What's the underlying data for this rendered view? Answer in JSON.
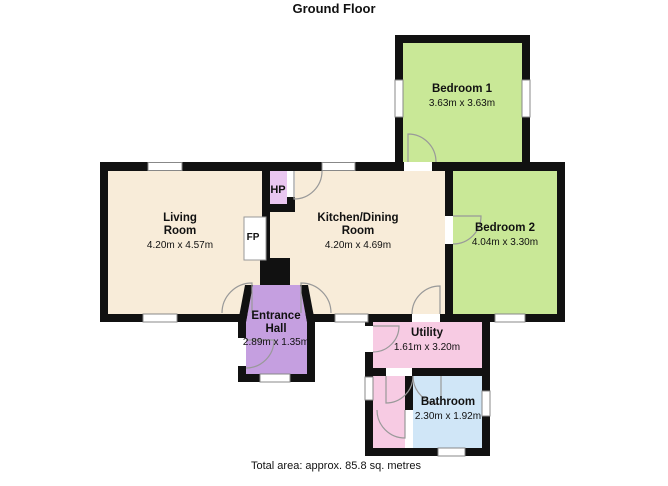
{
  "title": "Ground Floor",
  "footer": "Total area: approx. 85.8 sq. metres",
  "rooms": {
    "bedroom1": {
      "name": "Bedroom 1",
      "dims": "3.63m x 3.63m"
    },
    "bedroom2": {
      "name": "Bedroom 2",
      "dims": "4.04m x 3.30m"
    },
    "living": {
      "name_line1": "Living",
      "name_line2": "Room",
      "dims": "4.20m x 4.57m"
    },
    "kitchen": {
      "name_line1": "Kitchen/Dining",
      "name_line2": "Room",
      "dims": "4.20m x 4.69m"
    },
    "entrance": {
      "name_line1": "Entrance",
      "name_line2": "Hall",
      "dims": "2.89m x 1.35m"
    },
    "utility": {
      "name": "Utility",
      "dims": "1.61m x 3.20m"
    },
    "bathroom": {
      "name": "Bathroom",
      "dims": "2.30m x 1.92m"
    }
  },
  "annotations": {
    "hot_press": "HP",
    "fireplace": "FP"
  },
  "colors": {
    "wall": "#111111",
    "living_kitchen_floor": "#f8ecd9",
    "bedroom_floor": "#c9e897",
    "entrance_hall_floor": "#c59fe0",
    "hot_press_floor": "#e9c6f0",
    "utility_floor": "#f7cbe3",
    "bathroom_floor": "#d0e6f7",
    "window_border": "#888888",
    "door_arc": "#999999"
  }
}
